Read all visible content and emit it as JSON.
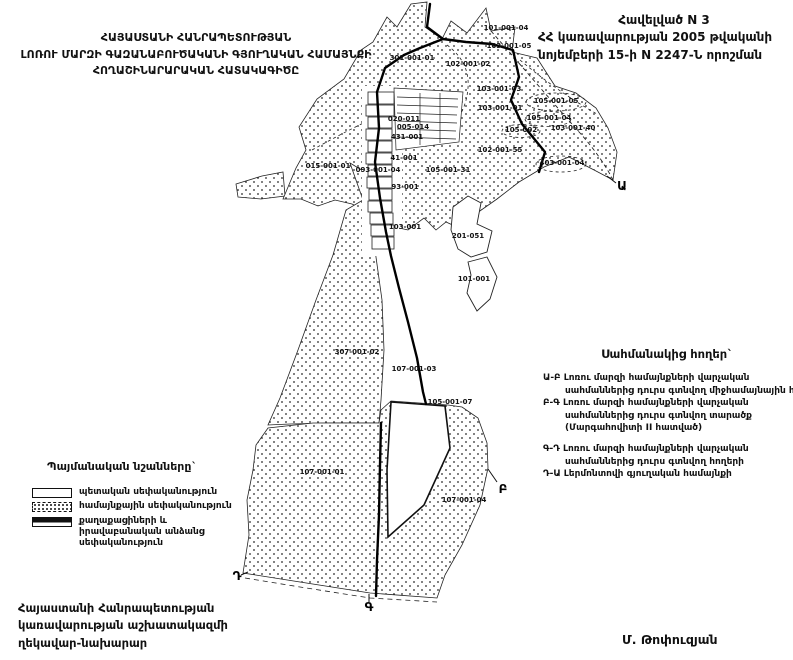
{
  "colors": {
    "ink": "#111111",
    "paper": "#ffffff"
  },
  "appendix": {
    "line1": "Հավելված N 3",
    "line2": "ՀՀ կառավարության 2005 թվականի",
    "line3": "նոյեմբերի 15-ի N 2247-Ն որոշման"
  },
  "title": {
    "line1": "ՀԱՅԱՍՏԱՆԻ ՀԱՆՐԱՊԵՏՈՒԹՅԱՆ",
    "line2": "ԼՈՌՈՒ ՄԱՐԶԻ ԳԱԶԱՆԱԲՈՒԾԱԿԱՆԻ ԳՅՈՒՂԱԿԱՆ ՀԱՄԱՅՆՔԻ",
    "line3": "ՀՈՂԱՇԻՆԱՐԱՐԱԿԱՆ ՀԱՏԱԿԱԳԻԾԸ"
  },
  "side_note": {
    "title": "Սահմանակից հողեր`",
    "lines": [
      {
        "text": "Ա-Բ Լոռու մարզի համայնքների վարչական",
        "indent": false
      },
      {
        "text": "սահմաններից դուրս գտնվող միջհամայնային հողեր",
        "indent": true
      },
      {
        "text": "Բ-Գ Լոռու մարզի համայնքների վարչական",
        "indent": false
      },
      {
        "text": "սահմաններից դուրս գտնվող տարածք",
        "indent": true
      },
      {
        "text": "(Մարգահովիտի II հատված)",
        "indent": true
      },
      {
        "text": "",
        "indent": false
      },
      {
        "text": "Գ-Դ Լոռու մարզի համայնքների վարչական",
        "indent": false
      },
      {
        "text": "սահմաններից դուրս գտնվող հողերի",
        "indent": true
      },
      {
        "text": "Դ-Ա Լերմոնտովի գյուղական համայնքի",
        "indent": false
      }
    ]
  },
  "legend": {
    "title": "Պայմանական նշանները`",
    "items": [
      {
        "swatch": "plain",
        "label": "պետական սեփականություն"
      },
      {
        "swatch": "dotted",
        "label": "համայնքային սեփականություն"
      },
      {
        "swatch": "hatched",
        "label": "քաղաքացիների և իրավաբանական անձանց սեփականություն"
      }
    ]
  },
  "footer": {
    "org_line1": "Հայաստանի Հանրապետության",
    "org_line2": "կառավարության աշխատակազմի",
    "org_line3": "ղեկավար-նախարար",
    "signature": "Մ. Թոփուզյան"
  },
  "map": {
    "parcels": [
      {
        "id": "101-001-04",
        "x": 506,
        "y": 28
      },
      {
        "id": "103-001-05",
        "x": 509,
        "y": 46
      },
      {
        "id": "301-001-01",
        "x": 412,
        "y": 58
      },
      {
        "id": "102-001-02",
        "x": 468,
        "y": 64
      },
      {
        "id": "103-001-03",
        "x": 499,
        "y": 89
      },
      {
        "id": "103-001-01",
        "x": 500,
        "y": 108
      },
      {
        "id": "105-001-05",
        "x": 556,
        "y": 101
      },
      {
        "id": "105-001-04",
        "x": 549,
        "y": 118
      },
      {
        "id": "103-001-40",
        "x": 573,
        "y": 128
      },
      {
        "id": "105-002",
        "x": 521,
        "y": 130
      },
      {
        "id": "102-001-55",
        "x": 500,
        "y": 150
      },
      {
        "id": "403-001-04",
        "x": 562,
        "y": 163
      },
      {
        "id": "015-001-01",
        "x": 328,
        "y": 166
      },
      {
        "id": "093-001-04",
        "x": 378,
        "y": 170
      },
      {
        "id": "105-001-31",
        "x": 448,
        "y": 170
      },
      {
        "id": "020-011",
        "x": 404,
        "y": 119
      },
      {
        "id": "005-014",
        "x": 413,
        "y": 127
      },
      {
        "id": "431-001",
        "x": 407,
        "y": 137
      },
      {
        "id": "41-001",
        "x": 404,
        "y": 158
      },
      {
        "id": "93-001",
        "x": 405,
        "y": 187
      },
      {
        "id": "103-001",
        "x": 405,
        "y": 227
      },
      {
        "id": "201-051",
        "x": 468,
        "y": 236
      },
      {
        "id": "101-001",
        "x": 474,
        "y": 279
      },
      {
        "id": "307-001-02",
        "x": 357,
        "y": 352
      },
      {
        "id": "107-001-03",
        "x": 414,
        "y": 369
      },
      {
        "id": "105-001-07",
        "x": 450,
        "y": 402
      },
      {
        "id": "107-001-01",
        "x": 322,
        "y": 472
      },
      {
        "id": "107-001-04",
        "x": 464,
        "y": 500
      }
    ],
    "boundary_points": [
      {
        "label": "Ա",
        "x": 622,
        "y": 186
      },
      {
        "label": "Բ",
        "x": 503,
        "y": 489
      },
      {
        "label": "Գ",
        "x": 369,
        "y": 607
      },
      {
        "label": "Դ",
        "x": 237,
        "y": 576
      }
    ]
  }
}
